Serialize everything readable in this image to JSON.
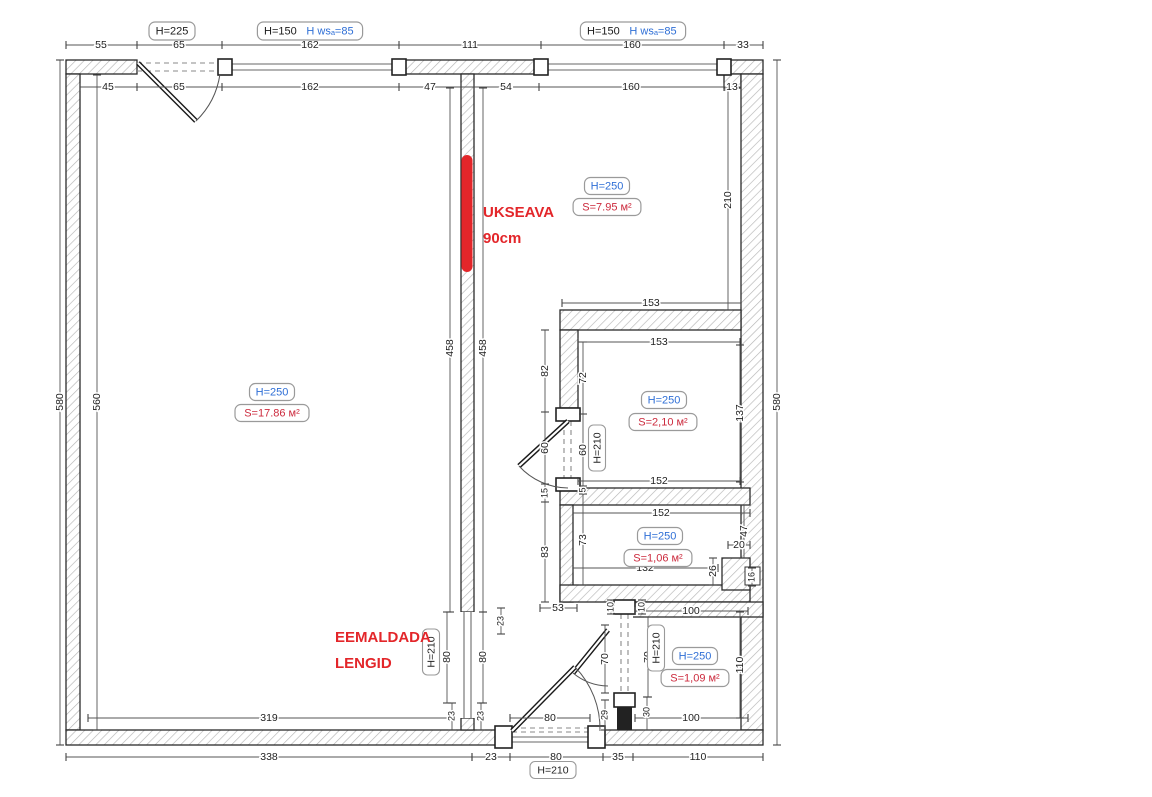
{
  "drawing": {
    "colors": {
      "blue": "#2f6fd6",
      "red_stat": "#cc2a3d",
      "red_marker": "#e3262a",
      "dim": "#222",
      "wall_hatch": "#b5b5b5"
    },
    "top_labels": [
      {
        "x": 172,
        "y": 31,
        "parts": [
          {
            "t": "H=225",
            "c": "#1a1a1a"
          }
        ]
      },
      {
        "x": 310,
        "y": 31,
        "parts": [
          {
            "t": "H=150",
            "c": "#1a1a1a"
          },
          {
            "t": "H wsₐ=85",
            "c": "#2f6fd6"
          }
        ]
      },
      {
        "x": 633,
        "y": 31,
        "parts": [
          {
            "t": "H=150",
            "c": "#1a1a1a"
          },
          {
            "t": "H wsₐ=85",
            "c": "#2f6fd6"
          }
        ]
      }
    ],
    "room_stats": [
      {
        "h": {
          "t": "H=250",
          "x": 272,
          "y": 392
        },
        "s": {
          "t": "S=17.86 м²",
          "x": 272,
          "y": 413
        }
      },
      {
        "h": {
          "t": "H=250",
          "x": 607,
          "y": 186
        },
        "s": {
          "t": "S=7.95 м²",
          "x": 607,
          "y": 207
        }
      },
      {
        "h": {
          "t": "H=250",
          "x": 664,
          "y": 400
        },
        "s": {
          "t": "S=2,10 м²",
          "x": 663,
          "y": 422
        }
      },
      {
        "h": {
          "t": "H=250",
          "x": 660,
          "y": 536
        },
        "s": {
          "t": "S=1,06 м²",
          "x": 658,
          "y": 558
        }
      },
      {
        "h": {
          "t": "H=250",
          "x": 695,
          "y": 656
        },
        "s": {
          "t": "S=1,09 м²",
          "x": 695,
          "y": 678
        }
      }
    ],
    "h210_labels": [
      {
        "t": "H=210",
        "x": 597,
        "y": 448,
        "r": 1
      },
      {
        "t": "H=210",
        "x": 431,
        "y": 652,
        "r": 1
      },
      {
        "t": "H=210",
        "x": 656,
        "y": 648,
        "r": 1
      },
      {
        "t": "H=210",
        "x": 553,
        "y": 770,
        "r": 0
      }
    ],
    "red_notes": [
      {
        "t": "UKSEAVA",
        "x": 483,
        "y": 213
      },
      {
        "t": "90cm",
        "x": 483,
        "y": 239
      },
      {
        "t": "EEMALDADA",
        "x": 335,
        "y": 638
      },
      {
        "t": "LENGID",
        "x": 335,
        "y": 664
      }
    ],
    "dims": [
      {
        "t": "55",
        "x": 101,
        "y": 45
      },
      {
        "t": "65",
        "x": 179,
        "y": 45
      },
      {
        "t": "162",
        "x": 310,
        "y": 45
      },
      {
        "t": "111",
        "x": 470,
        "y": 45
      },
      {
        "t": "160",
        "x": 632,
        "y": 45
      },
      {
        "t": "33",
        "x": 743,
        "y": 45
      },
      {
        "t": "45",
        "x": 108,
        "y": 87
      },
      {
        "t": "65",
        "x": 179,
        "y": 87
      },
      {
        "t": "162",
        "x": 310,
        "y": 87
      },
      {
        "t": "47",
        "x": 430,
        "y": 87
      },
      {
        "t": "54",
        "x": 506,
        "y": 87
      },
      {
        "t": "160",
        "x": 631,
        "y": 87
      },
      {
        "t": "13",
        "x": 732,
        "y": 87
      },
      {
        "t": "580",
        "x": 60,
        "y": 402,
        "r": 1
      },
      {
        "t": "560",
        "x": 97,
        "y": 402,
        "r": 1
      },
      {
        "t": "580",
        "x": 777,
        "y": 402,
        "r": 1
      },
      {
        "t": "458",
        "x": 450,
        "y": 348,
        "r": 1
      },
      {
        "t": "458",
        "x": 483,
        "y": 348,
        "r": 1
      },
      {
        "t": "210",
        "x": 728,
        "y": 200,
        "r": 1
      },
      {
        "t": "153",
        "x": 651,
        "y": 303
      },
      {
        "t": "153",
        "x": 659,
        "y": 342
      },
      {
        "t": "82",
        "x": 545,
        "y": 371,
        "r": 1
      },
      {
        "t": "72",
        "x": 583,
        "y": 378,
        "r": 1
      },
      {
        "t": "137",
        "x": 740,
        "y": 413,
        "r": 1
      },
      {
        "t": "60",
        "x": 545,
        "y": 448,
        "r": 1
      },
      {
        "t": "60",
        "x": 583,
        "y": 450,
        "r": 1
      },
      {
        "t": "152",
        "x": 659,
        "y": 481
      },
      {
        "t": "15",
        "x": 545,
        "y": 493,
        "r": 1,
        "s": 1
      },
      {
        "t": "5",
        "x": 583,
        "y": 490,
        "r": 1,
        "s": 1
      },
      {
        "t": "152",
        "x": 661,
        "y": 513
      },
      {
        "t": "73",
        "x": 583,
        "y": 540,
        "r": 1
      },
      {
        "t": "83",
        "x": 545,
        "y": 552,
        "r": 1
      },
      {
        "t": "132",
        "x": 645,
        "y": 568
      },
      {
        "t": "47",
        "x": 744,
        "y": 531,
        "r": 1
      },
      {
        "t": "20",
        "x": 739,
        "y": 545
      },
      {
        "t": "26",
        "x": 713,
        "y": 571,
        "r": 1
      },
      {
        "t": "16",
        "x": 752,
        "y": 577,
        "r": 1,
        "s": 1
      },
      {
        "t": "53",
        "x": 558,
        "y": 608
      },
      {
        "t": "10",
        "x": 611,
        "y": 607,
        "r": 1,
        "s": 1
      },
      {
        "t": "10",
        "x": 642,
        "y": 607,
        "r": 1,
        "s": 1
      },
      {
        "t": "100",
        "x": 691,
        "y": 611
      },
      {
        "t": "100",
        "x": 691,
        "y": 718
      },
      {
        "t": "110",
        "x": 740,
        "y": 665,
        "r": 1
      },
      {
        "t": "70",
        "x": 605,
        "y": 659,
        "r": 1
      },
      {
        "t": "70",
        "x": 648,
        "y": 657,
        "r": 1
      },
      {
        "t": "30",
        "x": 647,
        "y": 712,
        "r": 1,
        "s": 1
      },
      {
        "t": "29",
        "x": 605,
        "y": 715,
        "r": 1,
        "s": 1
      },
      {
        "t": "80",
        "x": 447,
        "y": 657,
        "r": 1
      },
      {
        "t": "80",
        "x": 483,
        "y": 657,
        "r": 1
      },
      {
        "t": "23",
        "x": 452,
        "y": 716,
        "r": 1,
        "s": 1
      },
      {
        "t": "23",
        "x": 481,
        "y": 716,
        "r": 1,
        "s": 1
      },
      {
        "t": "23",
        "x": 501,
        "y": 621,
        "r": 1,
        "s": 1
      },
      {
        "t": "319",
        "x": 269,
        "y": 718
      },
      {
        "t": "80",
        "x": 550,
        "y": 718
      },
      {
        "t": "338",
        "x": 269,
        "y": 757
      },
      {
        "t": "23",
        "x": 491,
        "y": 757
      },
      {
        "t": "80",
        "x": 556,
        "y": 757
      },
      {
        "t": "35",
        "x": 618,
        "y": 757
      },
      {
        "t": "110",
        "x": 698,
        "y": 757
      }
    ],
    "dim_lines": [
      {
        "p": [
          66,
          45,
          763,
          45
        ],
        "ticks": [
          66,
          137,
          222,
          399,
          541,
          724,
          763
        ]
      },
      {
        "p": [
          80,
          87,
          741,
          87
        ],
        "ticks": [
          80,
          137,
          222,
          399,
          461,
          474,
          539,
          724,
          741
        ]
      },
      {
        "p": [
          60,
          60,
          60,
          745
        ],
        "ticks": [
          60,
          745
        ]
      },
      {
        "p": [
          97,
          75,
          97,
          730
        ],
        "ticks": [
          75,
          730
        ]
      },
      {
        "p": [
          777,
          60,
          777,
          745
        ],
        "ticks": [
          60,
          745
        ]
      },
      {
        "p": [
          450,
          88,
          450,
          612
        ],
        "ticks": [
          88,
          612
        ]
      },
      {
        "p": [
          483,
          88,
          483,
          612
        ],
        "ticks": [
          88,
          612
        ]
      },
      {
        "p": [
          728,
          90,
          728,
          310
        ],
        "ticks": [
          90,
          310
        ]
      },
      {
        "p": [
          545,
          330,
          545,
          602
        ],
        "ticks": [
          330,
          412,
          484,
          502,
          602
        ]
      },
      {
        "p": [
          583,
          342,
          583,
          585
        ],
        "ticks": [
          342,
          414,
          486,
          494,
          585
        ]
      },
      {
        "p": [
          562,
          303,
          741,
          303
        ],
        "ticks": [
          562,
          741
        ]
      },
      {
        "p": [
          578,
          342,
          740,
          342
        ],
        "ticks": [
          578,
          740
        ]
      },
      {
        "p": [
          578,
          481,
          740,
          481
        ],
        "ticks": [
          578,
          740
        ]
      },
      {
        "p": [
          573,
          513,
          750,
          513
        ],
        "ticks": [
          573,
          750
        ]
      },
      {
        "p": [
          573,
          568,
          718,
          568
        ],
        "ticks": [
          573,
          718
        ]
      },
      {
        "p": [
          740,
          345,
          740,
          482
        ],
        "ticks": [
          345,
          482
        ]
      },
      {
        "p": [
          713,
          558,
          713,
          585
        ],
        "ticks": [
          558,
          585
        ]
      },
      {
        "p": [
          728,
          545,
          750,
          545
        ],
        "ticks": [
          728,
          750
        ]
      },
      {
        "p": [
          744,
          505,
          744,
          558
        ],
        "ticks": [
          505,
          558
        ]
      },
      {
        "p": [
          752,
          568,
          752,
          586
        ],
        "ticks": [
          568,
          586
        ]
      },
      {
        "p": [
          540,
          608,
          577,
          608
        ],
        "ticks": [
          540,
          577
        ]
      },
      {
        "p": [
          635,
          611,
          748,
          611
        ],
        "ticks": [
          635,
          748
        ]
      },
      {
        "p": [
          635,
          718,
          748,
          718
        ],
        "ticks": [
          635,
          748
        ]
      },
      {
        "p": [
          740,
          612,
          740,
          718
        ],
        "ticks": [
          612,
          718
        ]
      },
      {
        "p": [
          605,
          625,
          605,
          693
        ],
        "ticks": [
          625,
          693
        ]
      },
      {
        "p": [
          648,
          617,
          648,
          697
        ],
        "ticks": [
          617,
          697
        ]
      },
      {
        "p": [
          647,
          697,
          647,
          730
        ],
        "ticks": [
          697,
          730
        ]
      },
      {
        "p": [
          605,
          700,
          605,
          730
        ],
        "ticks": [
          700,
          730
        ]
      },
      {
        "p": [
          611,
          600,
          611,
          614
        ],
        "ticks": [
          600,
          614
        ]
      },
      {
        "p": [
          642,
          600,
          642,
          614
        ],
        "ticks": [
          600,
          614
        ]
      },
      {
        "p": [
          447,
          612,
          447,
          703
        ],
        "ticks": [
          612,
          703
        ]
      },
      {
        "p": [
          483,
          612,
          483,
          703
        ],
        "ticks": [
          612,
          703
        ]
      },
      {
        "p": [
          452,
          703,
          452,
          730
        ],
        "ticks": [
          703,
          730
        ]
      },
      {
        "p": [
          481,
          703,
          481,
          730
        ],
        "ticks": [
          703,
          730
        ]
      },
      {
        "p": [
          501,
          608,
          501,
          634
        ],
        "ticks": [
          608,
          634
        ]
      },
      {
        "p": [
          88,
          718,
          450,
          718
        ],
        "ticks": [
          88,
          450
        ]
      },
      {
        "p": [
          510,
          718,
          590,
          718
        ],
        "ticks": [
          510,
          590
        ]
      },
      {
        "p": [
          66,
          757,
          472,
          757
        ],
        "ticks": [
          66,
          472
        ]
      },
      {
        "p": [
          472,
          757,
          763,
          757
        ],
        "ticks": [
          472,
          510,
          603,
          633,
          763
        ]
      }
    ]
  }
}
